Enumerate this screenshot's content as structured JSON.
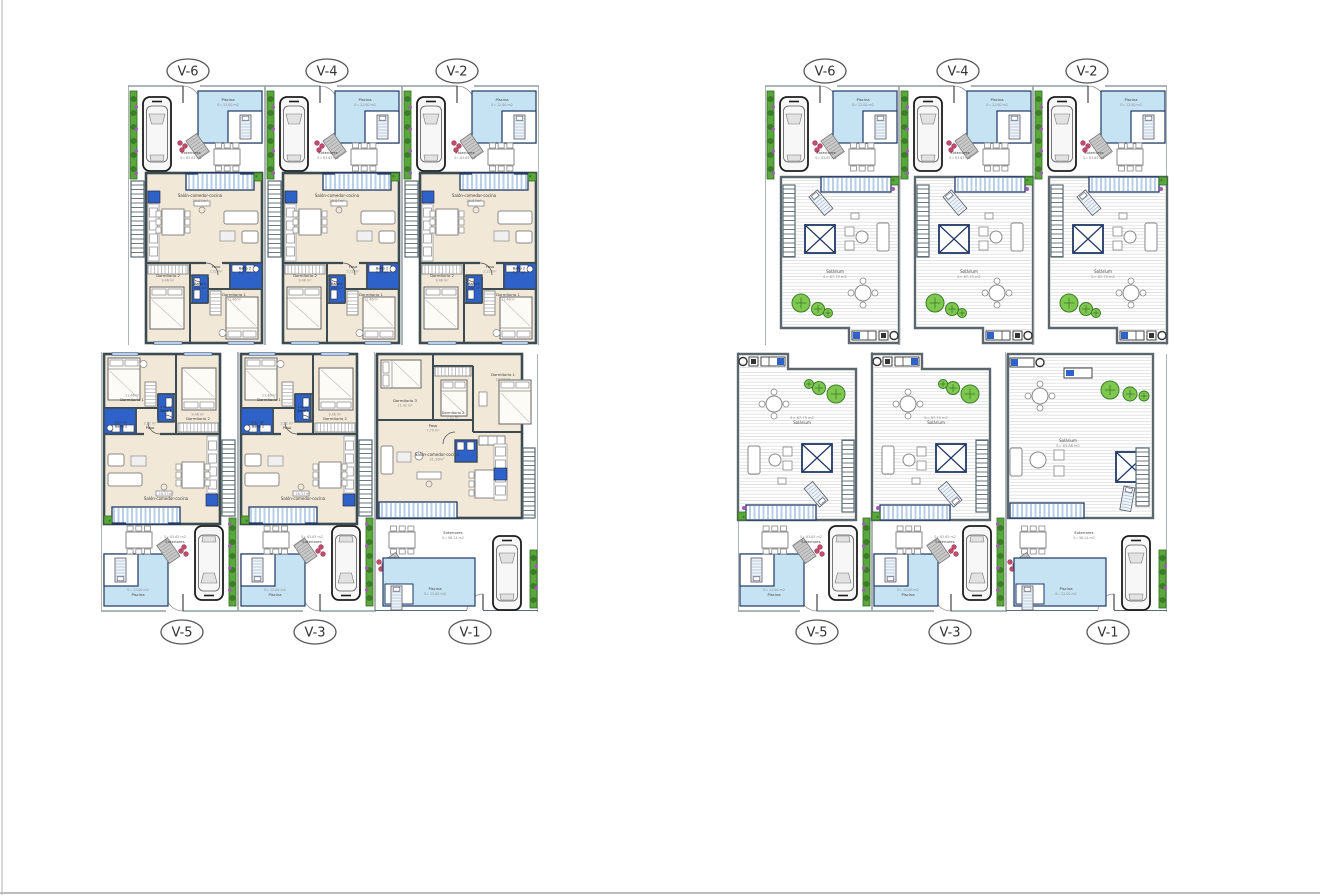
{
  "sheet": {
    "background": "#ffffff"
  },
  "blocks": {
    "floor": {
      "name": "distribution-plans",
      "top_labels": [
        "V-6",
        "V-4",
        "V-2"
      ],
      "bottom_labels": [
        "V-5",
        "V-3",
        "V-1"
      ]
    },
    "roof": {
      "name": "solarium-plans",
      "top_labels": [
        "V-6",
        "V-4",
        "V-2"
      ],
      "bottom_labels": [
        "V-5",
        "V-3",
        "V-1"
      ]
    }
  },
  "rooms": {
    "standard": {
      "salon": {
        "name": "Salón-comedor-cocina",
        "area": "26.57m²"
      },
      "paso": {
        "name": "Paso",
        "area": "2.22 m²"
      },
      "bano1": {
        "name": "Baño 1",
        "area": "2.56 m²"
      },
      "bano2": {
        "name": "Baño 2",
        "area": "2.17 m²"
      },
      "dorm1": {
        "name": "Dormitorio 1",
        "area": "11.46m²"
      },
      "dorm2": {
        "name": "Dormitorio 2",
        "area": "9.46 m²"
      }
    },
    "v1": {
      "salon": {
        "name": "Salón-comedor-cocina",
        "area": "31.26m²"
      },
      "paso": {
        "name": "Paso",
        "area": "7.79 m²"
      },
      "dorm1": {
        "name": "Dormitorio 1",
        "area": "12.47 m²"
      },
      "dorm2": {
        "name": "Dormitorio 2",
        "area": "7.51 m²"
      },
      "dorm3": {
        "name": "Dormitorio 3",
        "area": "11.42 m²"
      }
    }
  },
  "outdoor": {
    "piscina": {
      "name": "Piscina",
      "area": "S= 12.00 m2"
    },
    "exteriores": {
      "name": "Exteriores",
      "area": "S= 83.65 m2"
    },
    "exteriores_v1": {
      "name": "Exteriores",
      "area": "S= 98.24 m2"
    }
  },
  "solarium": {
    "standard": {
      "name": "Solárium",
      "area": "S= 67.75 m2"
    },
    "v1": {
      "name": "Solárium",
      "area": "S= 83.88 m2"
    }
  },
  "colors": {
    "wall": "#3c4b52",
    "line": "#5a6b72",
    "navy": "#1f3864",
    "bath_blue": "#2e62c9",
    "pool_fill": "#c6e3f4",
    "pool_edge": "#2e75b6",
    "floor": "#f1e8d8",
    "deck_stripe": "#b9cfe8",
    "solarium_stripe": "#d9d9d9",
    "hedge": "#5aa83c",
    "hedge_dark": "#3c7d28",
    "flower": "#a05bb5",
    "accent_red": "#c24a6a",
    "furniture": "#8a8f94",
    "text": "#3d3d3d",
    "text_light": "#8a8a8a",
    "label": "#333333"
  }
}
